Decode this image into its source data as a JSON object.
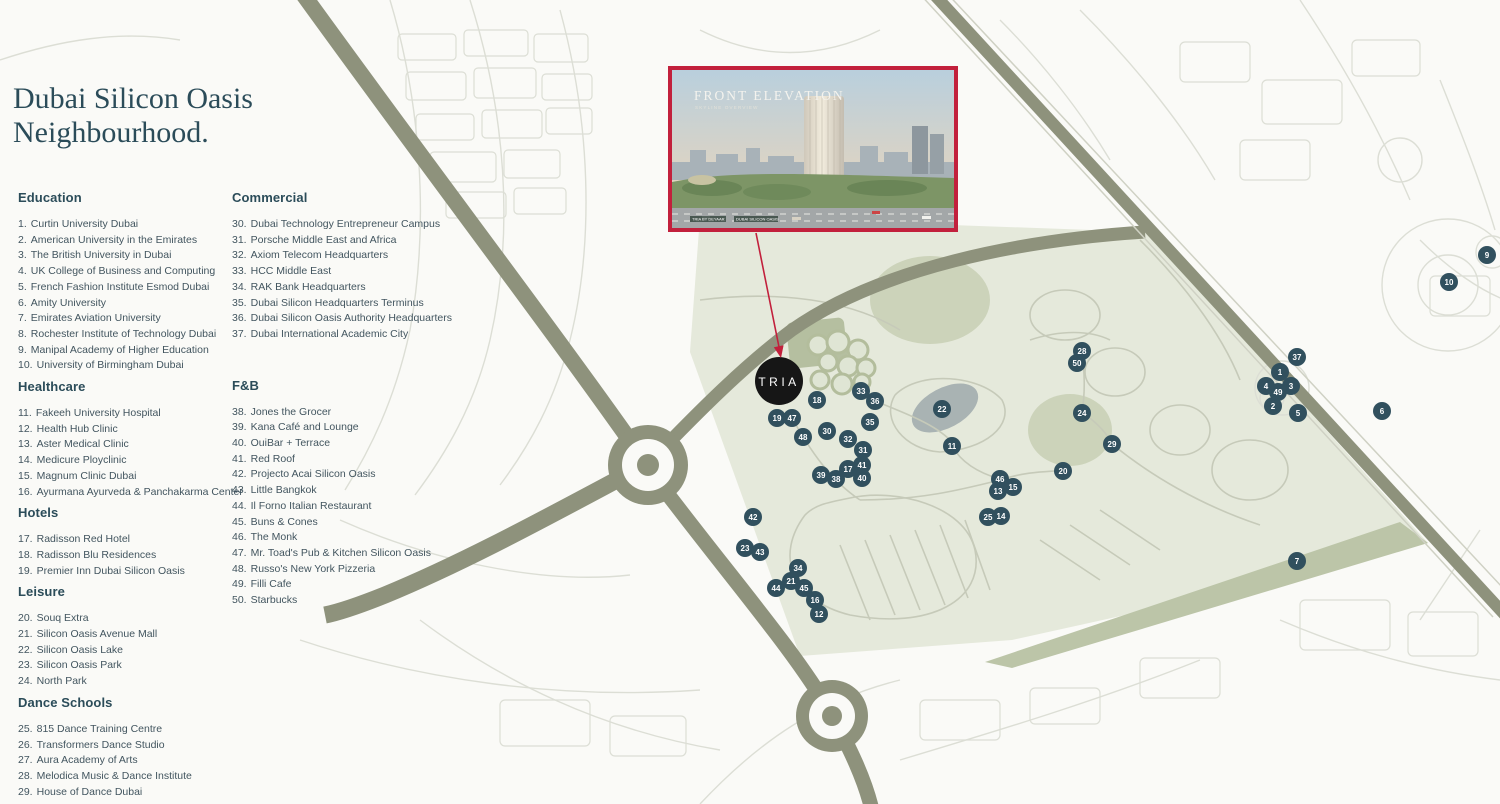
{
  "title": {
    "line1": "Dubai Silicon Oasis",
    "line2": "Neighbourhood."
  },
  "legend": {
    "columns": [
      {
        "sections": [
          {
            "heading": "Education",
            "items": [
              {
                "n": 1,
                "label": "Curtin University Dubai"
              },
              {
                "n": 2,
                "label": "American University in the Emirates"
              },
              {
                "n": 3,
                "label": "The British University in Dubai"
              },
              {
                "n": 4,
                "label": "UK College of Business and Computing"
              },
              {
                "n": 5,
                "label": "French Fashion Institute Esmod Dubai"
              },
              {
                "n": 6,
                "label": "Amity University"
              },
              {
                "n": 7,
                "label": "Emirates Aviation University"
              },
              {
                "n": 8,
                "label": "Rochester Institute of Technology Dubai"
              },
              {
                "n": 9,
                "label": "Manipal Academy of Higher Education"
              },
              {
                "n": 10,
                "label": "University of Birmingham Dubai"
              }
            ]
          },
          {
            "heading": "Healthcare",
            "items": [
              {
                "n": 11,
                "label": "Fakeeh University Hospital"
              },
              {
                "n": 12,
                "label": "Health Hub Clinic"
              },
              {
                "n": 13,
                "label": "Aster Medical Clinic"
              },
              {
                "n": 14,
                "label": "Medicure Ployclinic"
              },
              {
                "n": 15,
                "label": "Magnum Clinic Dubai"
              },
              {
                "n": 16,
                "label": "Ayurmana Ayurveda & Panchakarma Center"
              }
            ]
          },
          {
            "heading": "Hotels",
            "items": [
              {
                "n": 17,
                "label": "Radisson Red Hotel"
              },
              {
                "n": 18,
                "label": "Radisson Blu Residences"
              },
              {
                "n": 19,
                "label": "Premier Inn Dubai Silicon Oasis"
              }
            ]
          },
          {
            "heading": "Leisure",
            "items": [
              {
                "n": 20,
                "label": "Souq Extra"
              },
              {
                "n": 21,
                "label": "Silicon Oasis Avenue Mall"
              },
              {
                "n": 22,
                "label": "Silicon Oasis Lake"
              },
              {
                "n": 23,
                "label": "Silicon Oasis Park"
              },
              {
                "n": 24,
                "label": "North Park"
              }
            ]
          },
          {
            "heading": "Dance Schools",
            "items": [
              {
                "n": 25,
                "label": "815 Dance Training Centre"
              },
              {
                "n": 26,
                "label": "Transformers Dance Studio"
              },
              {
                "n": 27,
                "label": "Aura Academy of Arts"
              },
              {
                "n": 28,
                "label": "Melodica Music & Dance Institute"
              },
              {
                "n": 29,
                "label": "House of Dance Dubai"
              }
            ]
          }
        ]
      },
      {
        "sections": [
          {
            "heading": "Commercial",
            "items": [
              {
                "n": 30,
                "label": "Dubai Technology Entrepreneur Campus"
              },
              {
                "n": 31,
                "label": "Porsche Middle East and Africa"
              },
              {
                "n": 32,
                "label": "Axiom Telecom Headquarters"
              },
              {
                "n": 33,
                "label": "HCC Middle East"
              },
              {
                "n": 34,
                "label": "RAK Bank Headquarters"
              },
              {
                "n": 35,
                "label": "Dubai Silicon Headquarters Terminus"
              },
              {
                "n": 36,
                "label": "Dubai Silicon Oasis Authority Headquarters"
              },
              {
                "n": 37,
                "label": "Dubai International Academic City"
              }
            ]
          },
          {
            "heading": "F&B",
            "items": [
              {
                "n": 38,
                "label": "Jones the Grocer"
              },
              {
                "n": 39,
                "label": "Kana Café and Lounge"
              },
              {
                "n": 40,
                "label": "OuiBar + Terrace"
              },
              {
                "n": 41,
                "label": "Red Roof"
              },
              {
                "n": 42,
                "label": "Projecto Acai Silicon Oasis"
              },
              {
                "n": 43,
                "label": "Little Bangkok"
              },
              {
                "n": 44,
                "label": "Il Forno Italian Restaurant"
              },
              {
                "n": 45,
                "label": "Buns & Cones"
              },
              {
                "n": 46,
                "label": "The Monk"
              },
              {
                "n": 47,
                "label": "Mr. Toad's Pub & Kitchen Silicon Oasis"
              },
              {
                "n": 48,
                "label": "Russo's New York Pizzeria"
              },
              {
                "n": 49,
                "label": "Filli Cafe"
              },
              {
                "n": 50,
                "label": "Starbucks"
              }
            ]
          }
        ]
      }
    ]
  },
  "inset": {
    "title": "FRONT ELEVATION",
    "subtitle": "SKYLINE OVERVIEW",
    "sign_left": "TRIA BY DEYAAR",
    "sign_right": "DUBAI SILICON OASIS"
  },
  "map": {
    "project_label": "TRIA",
    "markers": [
      {
        "n": 1,
        "x": 1280,
        "y": 372
      },
      {
        "n": 2,
        "x": 1273,
        "y": 406
      },
      {
        "n": 3,
        "x": 1291,
        "y": 386
      },
      {
        "n": 4,
        "x": 1266,
        "y": 386
      },
      {
        "n": 5,
        "x": 1298,
        "y": 413
      },
      {
        "n": 6,
        "x": 1382,
        "y": 411
      },
      {
        "n": 7,
        "x": 1297,
        "y": 561
      },
      {
        "n": 9,
        "x": 1487,
        "y": 255
      },
      {
        "n": 10,
        "x": 1449,
        "y": 282
      },
      {
        "n": 11,
        "x": 952,
        "y": 446
      },
      {
        "n": 12,
        "x": 819,
        "y": 614
      },
      {
        "n": 13,
        "x": 998,
        "y": 491
      },
      {
        "n": 14,
        "x": 1001,
        "y": 516
      },
      {
        "n": 15,
        "x": 1013,
        "y": 487
      },
      {
        "n": 16,
        "x": 815,
        "y": 600
      },
      {
        "n": 17,
        "x": 848,
        "y": 469
      },
      {
        "n": 18,
        "x": 817,
        "y": 400
      },
      {
        "n": 19,
        "x": 777,
        "y": 418
      },
      {
        "n": 20,
        "x": 1063,
        "y": 471
      },
      {
        "n": 21,
        "x": 791,
        "y": 581
      },
      {
        "n": 22,
        "x": 942,
        "y": 409
      },
      {
        "n": 23,
        "x": 745,
        "y": 548
      },
      {
        "n": 24,
        "x": 1082,
        "y": 413
      },
      {
        "n": 25,
        "x": 988,
        "y": 517
      },
      {
        "n": 28,
        "x": 1082,
        "y": 351
      },
      {
        "n": 29,
        "x": 1112,
        "y": 444
      },
      {
        "n": 30,
        "x": 827,
        "y": 431
      },
      {
        "n": 31,
        "x": 863,
        "y": 450
      },
      {
        "n": 32,
        "x": 848,
        "y": 439
      },
      {
        "n": 33,
        "x": 861,
        "y": 391
      },
      {
        "n": 34,
        "x": 798,
        "y": 568
      },
      {
        "n": 35,
        "x": 870,
        "y": 422
      },
      {
        "n": 36,
        "x": 875,
        "y": 401
      },
      {
        "n": 37,
        "x": 1297,
        "y": 357
      },
      {
        "n": 38,
        "x": 836,
        "y": 479
      },
      {
        "n": 39,
        "x": 821,
        "y": 475
      },
      {
        "n": 40,
        "x": 862,
        "y": 478
      },
      {
        "n": 41,
        "x": 862,
        "y": 465
      },
      {
        "n": 42,
        "x": 753,
        "y": 517
      },
      {
        "n": 43,
        "x": 760,
        "y": 552
      },
      {
        "n": 44,
        "x": 776,
        "y": 588
      },
      {
        "n": 45,
        "x": 804,
        "y": 588
      },
      {
        "n": 46,
        "x": 1000,
        "y": 479
      },
      {
        "n": 47,
        "x": 792,
        "y": 418
      },
      {
        "n": 48,
        "x": 803,
        "y": 437
      },
      {
        "n": 49,
        "x": 1278,
        "y": 392
      },
      {
        "n": 50,
        "x": 1077,
        "y": 363
      }
    ]
  },
  "colors": {
    "accent_red": "#c2203c",
    "marker": "#31505e",
    "tria_black": "#161616",
    "heading_text": "#2b4c59",
    "sage": "#e5e9db",
    "sage_dark": "#ccd3ba",
    "olive_road": "#8e927c",
    "lake": "#a9b3b3",
    "street": "#dcded5",
    "street_inner": "#c6cab9"
  }
}
